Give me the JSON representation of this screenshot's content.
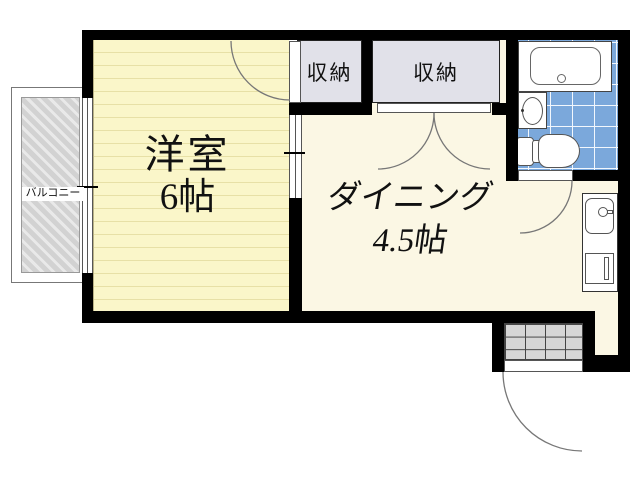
{
  "floorplan": {
    "balcony_label": "バルコニー",
    "western_room": {
      "name": "洋室",
      "size": "6帖"
    },
    "dining": {
      "name": "ダイニング",
      "size": "4.5帖"
    },
    "closet_small_label": "収納",
    "closet_large_label": "収納",
    "fixtures": [
      "bathtub",
      "washbasin",
      "toilet",
      "kitchen-sink",
      "entrance-door",
      "genkan-tile"
    ],
    "colors": {
      "wall": "#000000",
      "western_room_fill": "#FAF6C9",
      "western_room_stripe": "#E7E0A6",
      "dining_fill": "#FBF7E4",
      "closet_fill": "#E1E1E9",
      "bath_tile": "#7BA8DB",
      "balcony_hatch": "#D2D2D2",
      "genkan_tile": "#D6D6D6"
    }
  }
}
